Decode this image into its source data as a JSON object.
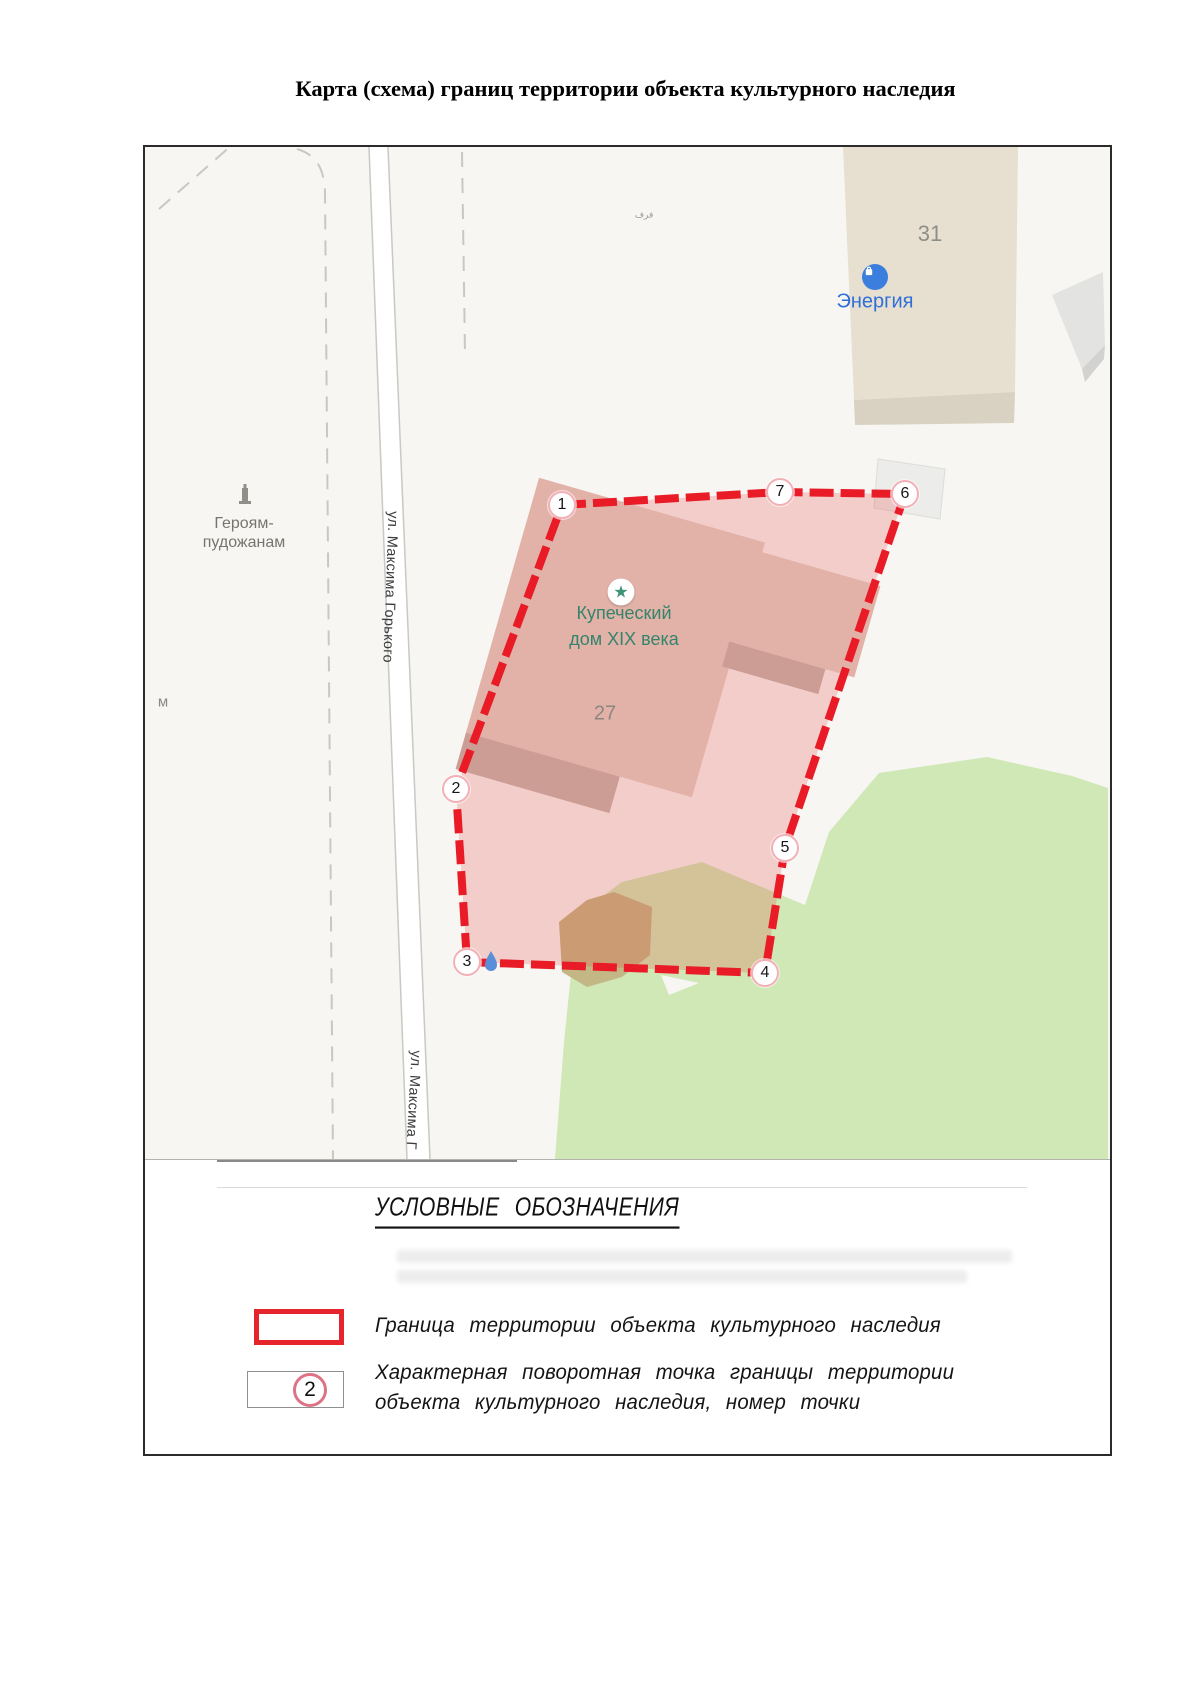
{
  "title": "Карта (схема) границ территории объекта культурного наследия",
  "map": {
    "street_label_1": "ул. Максима Горького",
    "street_label_2": "ул. Максима Г",
    "monument": {
      "label": "Героям-\nпудожанам"
    },
    "heritage_object": {
      "name_line1": "Купеческий",
      "name_line2": "дом XIX века",
      "star_glyph": "★",
      "building_number": "27"
    },
    "shop": {
      "name": "Энергия",
      "building_number": "31"
    },
    "edge_label": "м",
    "small_glyph": "فرف",
    "points": [
      {
        "n": "1",
        "x": 417,
        "y": 358
      },
      {
        "n": "2",
        "x": 311,
        "y": 642
      },
      {
        "n": "3",
        "x": 322,
        "y": 815
      },
      {
        "n": "4",
        "x": 620,
        "y": 826
      },
      {
        "n": "5",
        "x": 640,
        "y": 701
      },
      {
        "n": "6",
        "x": 760,
        "y": 347
      },
      {
        "n": "7",
        "x": 635,
        "y": 345
      }
    ],
    "colors": {
      "boundary_red": "#e81b26",
      "boundary_fill": "rgba(230,60,55,0.22)",
      "marker_ring": "#f2b0b6",
      "green_area": "#cfe8b5",
      "olive_area": "#c3b786",
      "building_31": "#e7e0d1",
      "building_27": "#e2b2a9",
      "poi_blue": "#3b7ede",
      "poi_green": "#3f9477",
      "map_background": "#f7f6f3"
    }
  },
  "legend": {
    "heading": "УСЛОВНЫЕ ОБОЗНАЧЕНИЯ",
    "items": [
      {
        "label": "Граница территории объекта культурного наследия"
      },
      {
        "symbol_number": "2",
        "label_line1": "Характерная поворотная точка границы территории",
        "label_line2": "объекта культурного наследия, номер точки"
      }
    ]
  }
}
